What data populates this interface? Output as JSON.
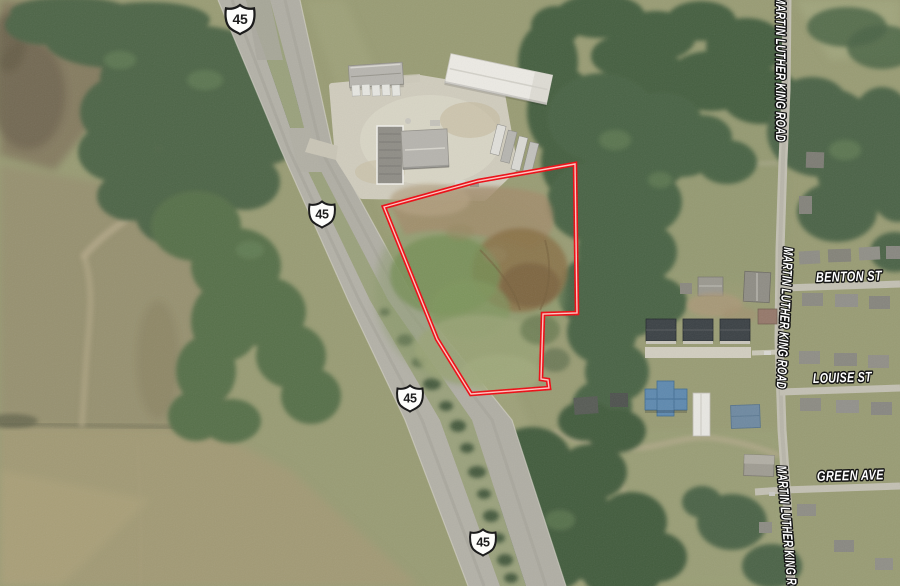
{
  "map": {
    "parcel": {
      "boundary_color": "#ee0a12",
      "boundary_inner_color": "#ffd2cc"
    },
    "route_shields": [
      {
        "route": "45"
      },
      {
        "route": "45"
      },
      {
        "route": "45"
      },
      {
        "route": "45"
      }
    ],
    "street_labels": {
      "mlk_top": "MARTIN LUTHER KING ROAD",
      "mlk_mid": "MARTIN LUTHER KING ROAD",
      "mlk_bottom": "MARTIN LUTHER KING ROAD",
      "benton": "BENTON ST",
      "louise": "LOUISE ST",
      "green": "GREEN AVE"
    },
    "label_style": {
      "text_color": "#ffffff",
      "outline_color": "#141414"
    }
  }
}
